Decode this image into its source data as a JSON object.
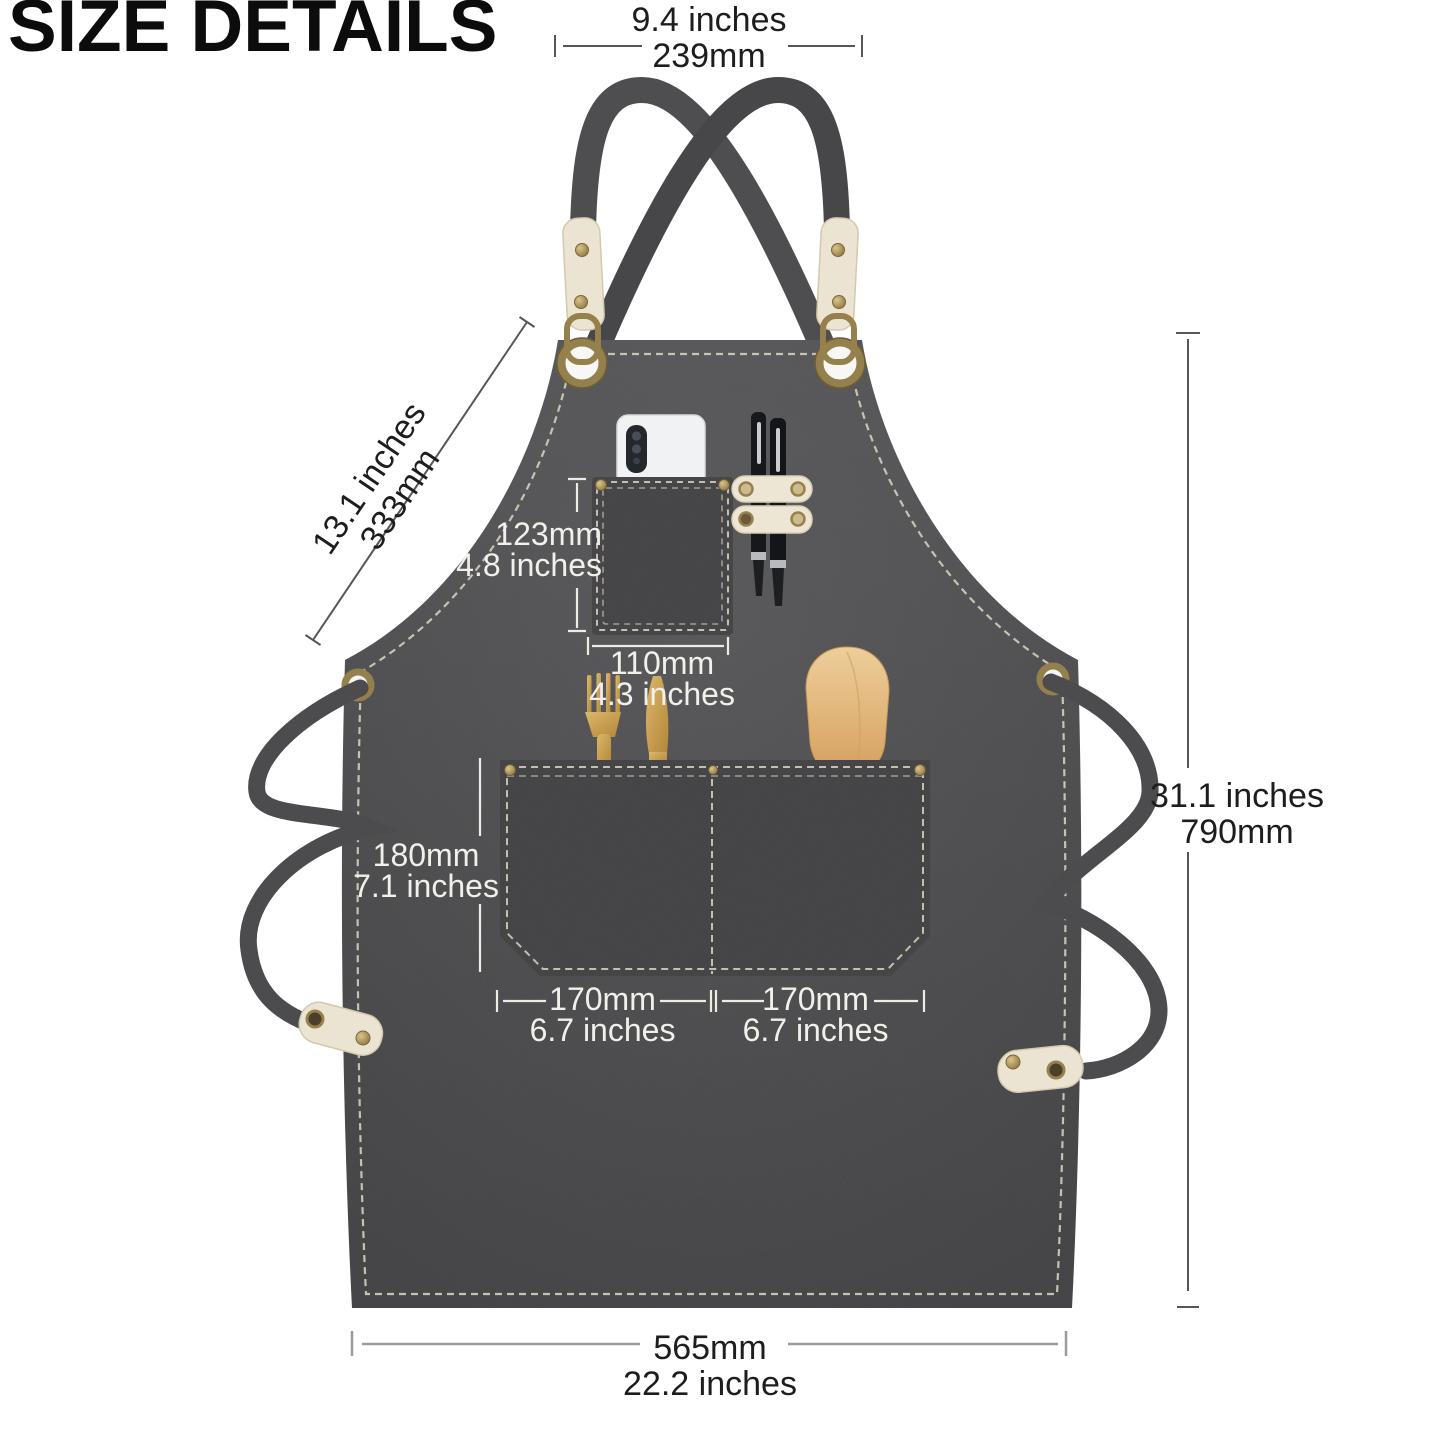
{
  "title": "SIZE DETAILS",
  "dimensions": {
    "strap_top_width": {
      "inches": "9.4 inches",
      "mm": "239mm"
    },
    "bib_slant": {
      "inches": "13.1 inches",
      "mm": "333mm"
    },
    "chest_pocket_height": {
      "mm": "123mm",
      "inches": "4.8 inches"
    },
    "chest_pocket_width": {
      "mm": "110mm",
      "inches": "4.3 inches"
    },
    "front_pocket_height": {
      "mm": "180mm",
      "inches": "7.1 inches"
    },
    "front_pocket_left_width": {
      "mm": "170mm",
      "inches": "6.7 inches"
    },
    "front_pocket_right_width": {
      "mm": "170mm",
      "inches": "6.7 inches"
    },
    "apron_length": {
      "inches": "31.1 inches",
      "mm": "790mm"
    },
    "bottom_width": {
      "mm": "565mm",
      "inches": "22.2 inches"
    }
  },
  "objects": [
    "apron",
    "cross-back straps",
    "phone",
    "pens",
    "fork",
    "knife",
    "spatula"
  ],
  "colors": {
    "background": "#ffffff",
    "apron_fabric": "#47474a",
    "stitching": "#d5cebd",
    "leather_tab": "#ece4d2",
    "brass_hardware": "#96804b",
    "gold_cutlery": "#c9a257",
    "wood_spatula": "#e0b476",
    "label_dark": "#1d1d1d",
    "label_light": "#f2f0ea"
  }
}
